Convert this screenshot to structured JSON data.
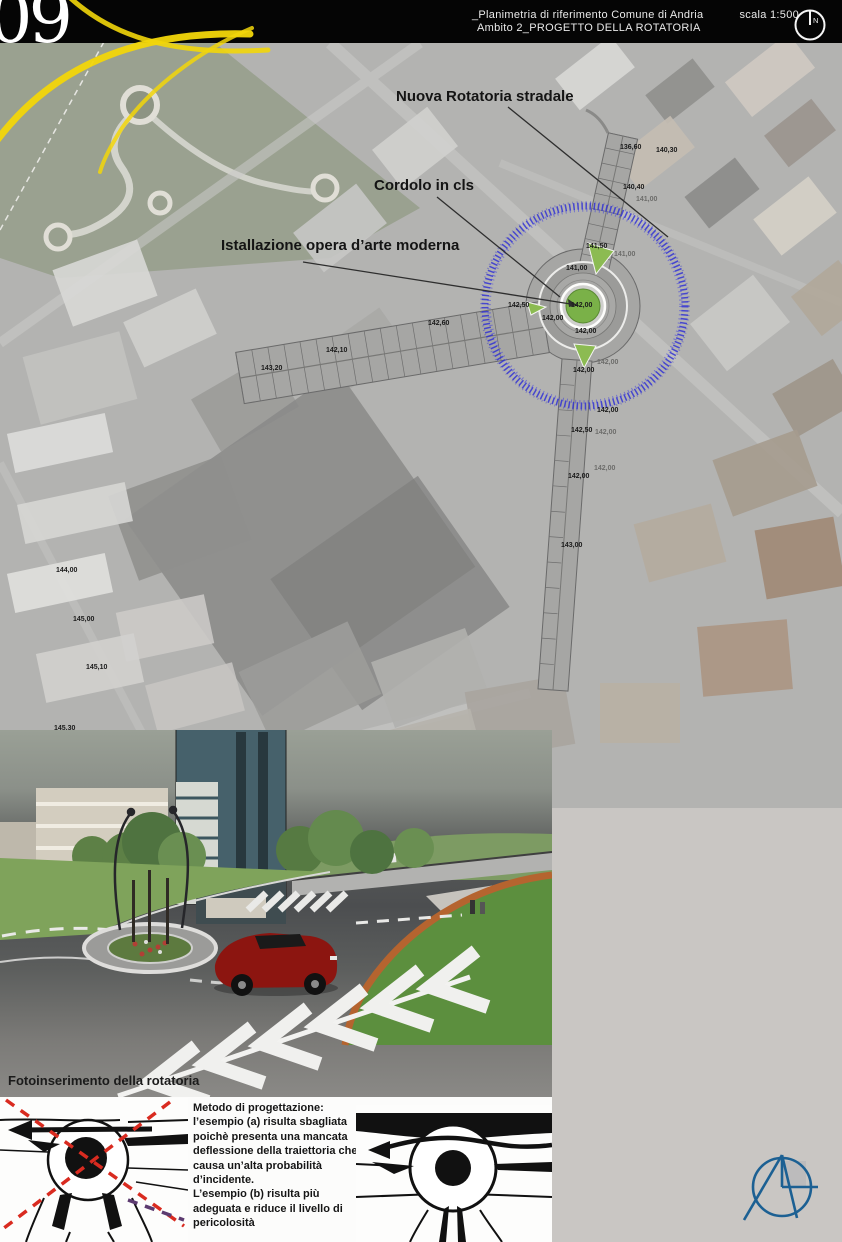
{
  "header": {
    "sheet_number": "09",
    "plan_title": "_Planimetria di riferimento Comune di Andria",
    "scale_label": "scala 1:500",
    "subtitle": "Ambito 2_PROGETTO DELLA ROTATORIA",
    "north_letter": "N"
  },
  "plan": {
    "annotations": [
      {
        "label": "Nuova Rotatoria stradale",
        "x": 396,
        "y": 88
      },
      {
        "label": "Cordolo in cls",
        "x": 374,
        "y": 177
      },
      {
        "label": "Istallazione opera d’arte moderna",
        "x": 221,
        "y": 237
      }
    ],
    "elevation_labels": [
      {
        "text": "136,60",
        "x": 620,
        "y": 144
      },
      {
        "text": "140,30",
        "x": 656,
        "y": 147
      },
      {
        "text": "140,40",
        "x": 623,
        "y": 184
      },
      {
        "text": "141,00",
        "x": 636,
        "y": 196,
        "faint": true
      },
      {
        "text": "141,50",
        "x": 586,
        "y": 243
      },
      {
        "text": "141,00",
        "x": 566,
        "y": 265
      },
      {
        "text": "141,00",
        "x": 614,
        "y": 251,
        "faint": true
      },
      {
        "text": "142,50",
        "x": 508,
        "y": 302
      },
      {
        "text": "142,00",
        "x": 571,
        "y": 302
      },
      {
        "text": "142,00",
        "x": 542,
        "y": 315
      },
      {
        "text": "142,00",
        "x": 575,
        "y": 328
      },
      {
        "text": "142,00",
        "x": 597,
        "y": 359,
        "faint": true
      },
      {
        "text": "142,00",
        "x": 573,
        "y": 367
      },
      {
        "text": "142,00",
        "x": 597,
        "y": 407
      },
      {
        "text": "142,50",
        "x": 571,
        "y": 427
      },
      {
        "text": "142,00",
        "x": 595,
        "y": 429,
        "faint": true
      },
      {
        "text": "142,00",
        "x": 594,
        "y": 465,
        "faint": true
      },
      {
        "text": "142,00",
        "x": 568,
        "y": 473
      },
      {
        "text": "143,00",
        "x": 561,
        "y": 542
      },
      {
        "text": "142,60",
        "x": 428,
        "y": 320
      },
      {
        "text": "142,10",
        "x": 326,
        "y": 347
      },
      {
        "text": "143,20",
        "x": 261,
        "y": 365
      },
      {
        "text": "144,00",
        "x": 56,
        "y": 567
      },
      {
        "text": "145,00",
        "x": 73,
        "y": 616
      },
      {
        "text": "145,10",
        "x": 86,
        "y": 664
      },
      {
        "text": "145,30",
        "x": 54,
        "y": 725
      }
    ],
    "colors": {
      "ring_blue": "#2a2ad6",
      "island_green": "#7ab148",
      "sketch_yellow": "#f0d400",
      "road_gray": "#a6a6a4"
    }
  },
  "render": {
    "caption": "Fotoinserimento della rotatoria"
  },
  "method_note": {
    "heading": "Metodo di progettazione:",
    "body": "l’esempio (a) risulta sbagliata\npoichè presenta una mancata\ndeflessione della traiettoria che\ncausa un’alta probabilità\nd’incidente.\nL’esempio (b) risulta più\nadeguata e riduce il livello di\npericolosità"
  },
  "logo_color": "#1c6093",
  "danger_red": "#d92b20"
}
